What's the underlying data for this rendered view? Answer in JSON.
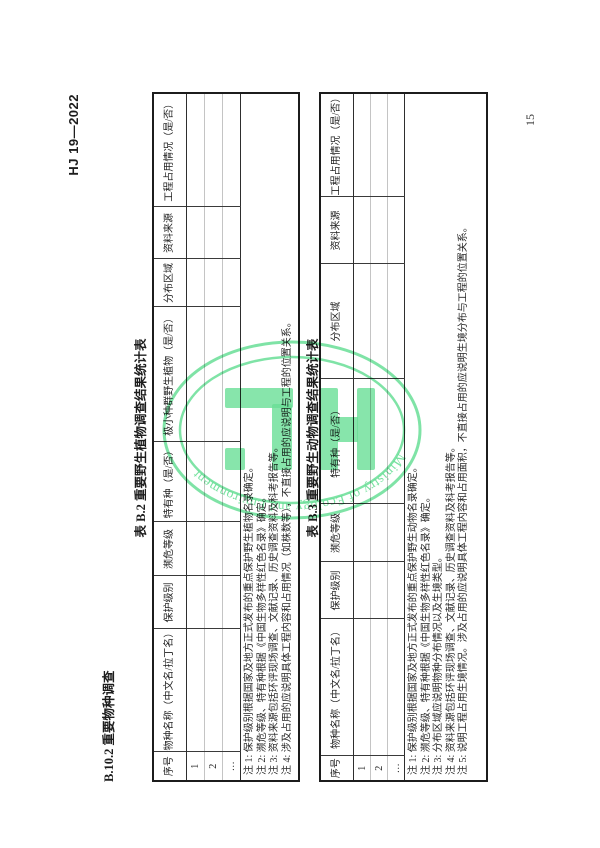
{
  "page": {
    "doc_number": "HJ 19—2022",
    "page_number": "15",
    "section_heading": "B.10.2  重要物种调查"
  },
  "watermark": {
    "arc_text": "Ministry of Ecology and Environment",
    "color": "#69de96"
  },
  "table_b2": {
    "title": "表 B.2  重要野生植物调查结果统计表",
    "columns": [
      "序号",
      "物种名称（中文名/拉丁名）",
      "保护级别",
      "濒危等级",
      "特有种（是/否）",
      "极小种群野生植物（是/否）",
      "分布区域",
      "资料来源",
      "工程占用情况（是/否）"
    ],
    "row_labels": [
      "1",
      "2",
      "…"
    ],
    "notes": [
      "注 1: 保护级别根据国家及地方正式发布的重点保护野生植物名录确定。",
      "注 2: 濒危等级、特有种根据《中国生物多样性红色名录》确定。",
      "注 3: 资料来源包括环评现场调查、文献记录、历史调查资料及科考报告等。",
      "注 4: 涉及占用的应说明具体工程内容和占用情况（如株数等），不直接占用的应说明与工程的位置关系。"
    ]
  },
  "table_b3": {
    "title": "表 B.3  重要野生动物调查结果统计表",
    "columns": [
      "序号",
      "物种名称（中文名/拉丁名）",
      "保护级别",
      "濒危等级",
      "特有种（是/否）",
      "分布区域",
      "资料来源",
      "工程占用情况（是/否）"
    ],
    "row_labels": [
      "1",
      "2",
      "…"
    ],
    "notes": [
      "注 1: 保护级别根据国家及地方正式发布的重点保护野生动物名录确定。",
      "注 2: 濒危等级、特有种根据《中国生物多样性红色名录》确定。",
      "注 3: 分布区域应说明物种分布情况以及生境类型。",
      "注 4: 资料来源包括环评现场调查、文献记录、历史调查资料及科考报告等。",
      "注 5: 说明工程占用生境情况。涉及占用的应说明具体工程内容和占用面积，不直接占用的应说明生境分布与工程的位置关系。"
    ]
  }
}
